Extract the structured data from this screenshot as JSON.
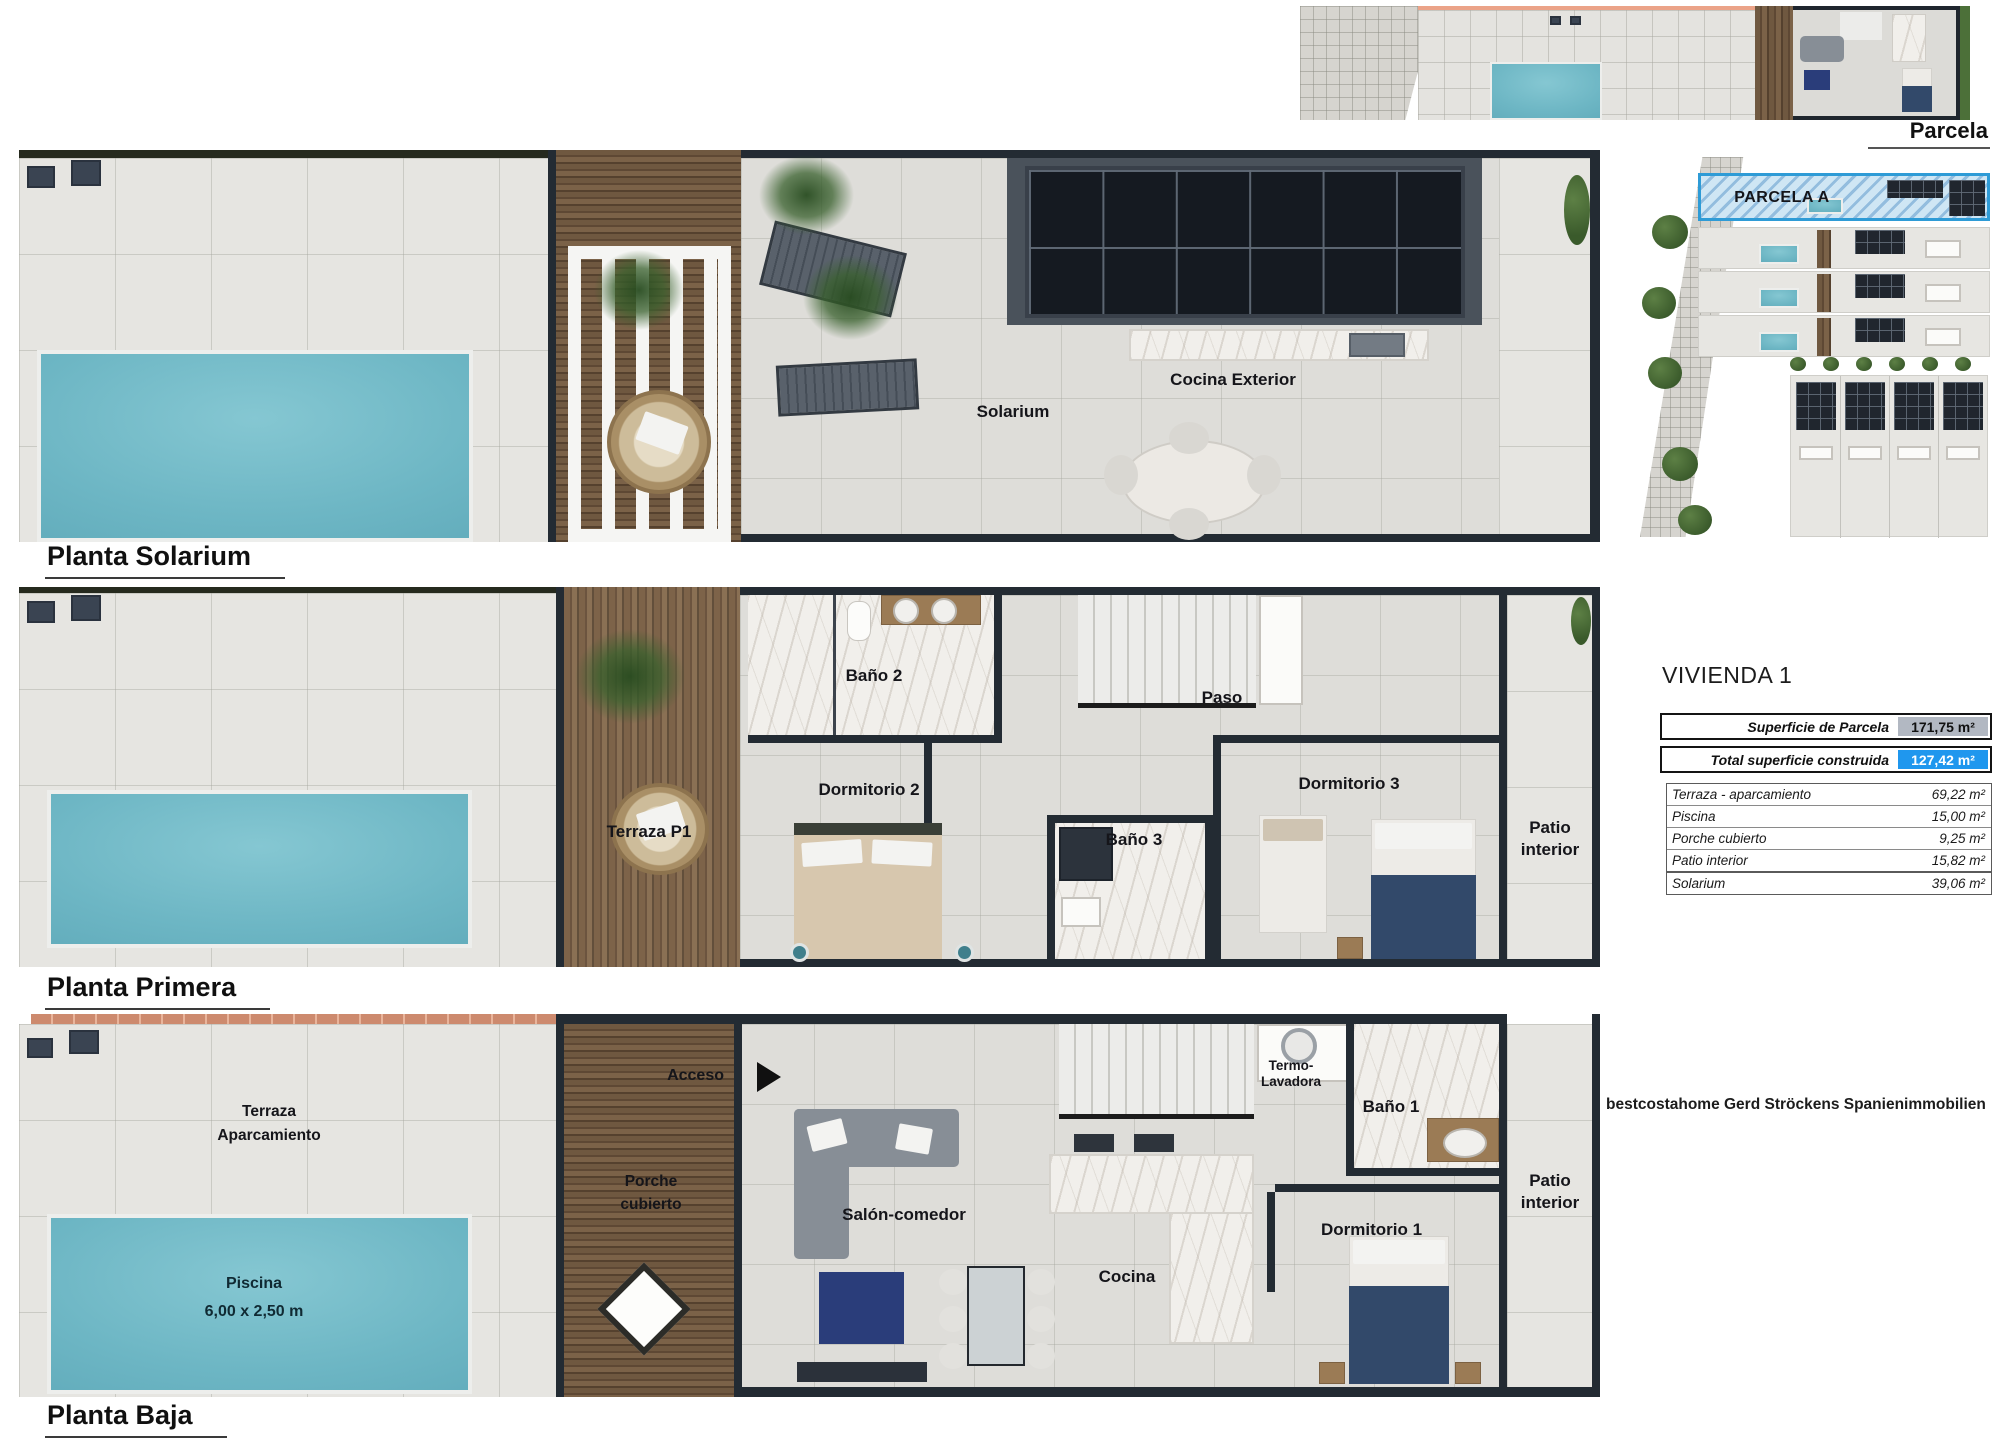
{
  "parcela_strip": {
    "label": "Parcela"
  },
  "site_plan": {
    "label": "PARCELA A"
  },
  "vivienda": {
    "title": "VIVIENDA 1",
    "summary": [
      {
        "label": "Superficie de Parcela",
        "value": "171,75 m²"
      },
      {
        "label": "Total superficie  construida",
        "value": "127,42 m²"
      }
    ],
    "details": [
      {
        "label": "Terraza - aparcamiento",
        "value": "69,22 m²"
      },
      {
        "label": "Piscina",
        "value": "15,00 m²"
      },
      {
        "label": "Porche cubierto",
        "value": "9,25 m²"
      },
      {
        "label": "Patio interior",
        "value": "15,82 m²"
      }
    ],
    "solarium_row": {
      "label": "Solarium",
      "value": "39,06 m²"
    }
  },
  "floors": {
    "solarium": {
      "title": "Planta Solarium",
      "labels": {
        "solarium": "Solarium",
        "cocina_exterior": "Cocina Exterior"
      }
    },
    "primera": {
      "title": "Planta Primera",
      "labels": {
        "bano2": "Baño 2",
        "paso": "Paso",
        "terraza_p1": "Terraza P1",
        "dormitorio2": "Dormitorio 2",
        "bano3": "Baño 3",
        "dormitorio3": "Dormitorio 3",
        "patio_line1": "Patio",
        "patio_line2": "interior"
      }
    },
    "baja": {
      "title": "Planta Baja",
      "labels": {
        "acceso": "Acceso",
        "terraza_line1": "Terraza",
        "terraza_line2": "Aparcamiento",
        "porche_line1": "Porche",
        "porche_line2": "cubierto",
        "salon_comedor": "Salón-comedor",
        "termo_line1": "Termo-",
        "termo_line2": "Lavadora",
        "bano1": "Baño 1",
        "cocina": "Cocina",
        "dormitorio1": "Dormitorio 1",
        "patio_line1": "Patio",
        "patio_line2": "interior",
        "piscina_line1": "Piscina",
        "piscina_line2": "6,00 x 2,50 m"
      }
    }
  },
  "watermark": "bestcostahome Gerd Ströckens Spanienimmobilien",
  "colors": {
    "pool": "#6db6c4",
    "wood": "#6f5840",
    "wall": "#232b33",
    "tile": "#e6e5e1",
    "brick": "#cd8a6e",
    "highlight_blue": "#1f97ee",
    "highlight_gray": "#b2b8c2",
    "parcela_border": "#2e9bd6",
    "hedge": "#4c7039"
  }
}
